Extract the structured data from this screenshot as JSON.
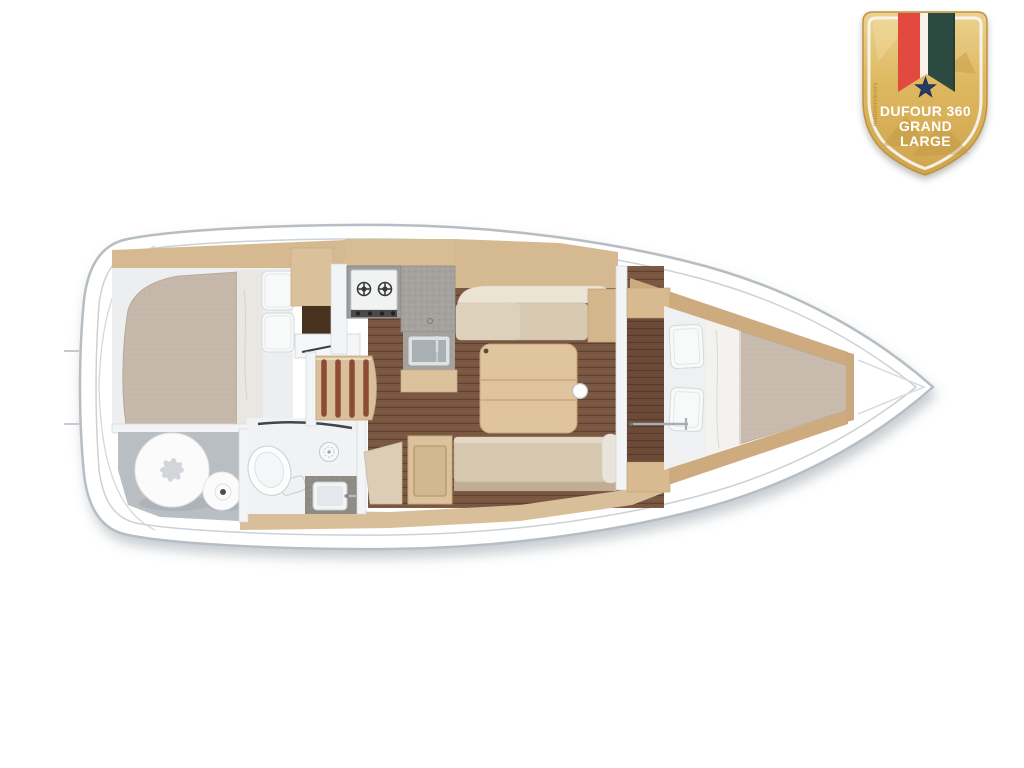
{
  "page": {
    "background": "#ffffff",
    "description": "Top-down interior layout plan of a sailing yacht"
  },
  "badge": {
    "title_line1": "DUFOUR 360",
    "title_line2": "GRAND",
    "title_line3": "LARGE",
    "watermark": "madeforsailors",
    "colors": {
      "gold": "#ddb75f",
      "gold_dark": "#bb9340",
      "gold_light": "#ecd28f",
      "border_white": "#f5f4f0",
      "ribbon_red": "#e24a40",
      "ribbon_white": "#f7f3ea",
      "ribbon_green": "#2d4a41",
      "star_navy": "#243a63",
      "text": "#ffffff"
    }
  },
  "floorplan": {
    "boat_model": "Dufour 360 Grand Large",
    "view": "top-down interior layout",
    "areas": [
      {
        "name": "aft-cabin",
        "features": [
          "double-berth",
          "two-pillows",
          "wardrobe-niche"
        ]
      },
      {
        "name": "sail-locker",
        "features": [
          "stowed-sails"
        ]
      },
      {
        "name": "head",
        "features": [
          "toilet",
          "shower-drain",
          "vanity-sink",
          "door"
        ]
      },
      {
        "name": "companionway",
        "features": [
          "stairs"
        ]
      },
      {
        "name": "chart-shelf",
        "features": [
          "pencil"
        ]
      },
      {
        "name": "galley",
        "features": [
          "two-burner-stove",
          "countertop",
          "sink"
        ]
      },
      {
        "name": "saloon",
        "features": [
          "l-sofa",
          "folding-table",
          "bench-seat",
          "storage-cabinet",
          "corner-seat"
        ]
      },
      {
        "name": "forward-cabin",
        "features": [
          "v-berth",
          "two-pillows",
          "grab-rail",
          "entry-bulkhead"
        ]
      },
      {
        "name": "bow-locker",
        "features": []
      }
    ],
    "colors": {
      "hull_outline": "#b6bdc3",
      "deck": "#ffffff",
      "wood_light": "#dcc29c",
      "wood_band": "#d5ba91",
      "floor_brown": "#7a5741",
      "floor_dark": "#6b4a38",
      "cushion": "#d8c9b2",
      "mattress": "#c6b9ab",
      "bedding_white": "#f7f8f8",
      "counter_gray": "#a5a19c",
      "bathroom_floor": "#f0f2f3",
      "locker_floor": "#b9bec2"
    }
  }
}
